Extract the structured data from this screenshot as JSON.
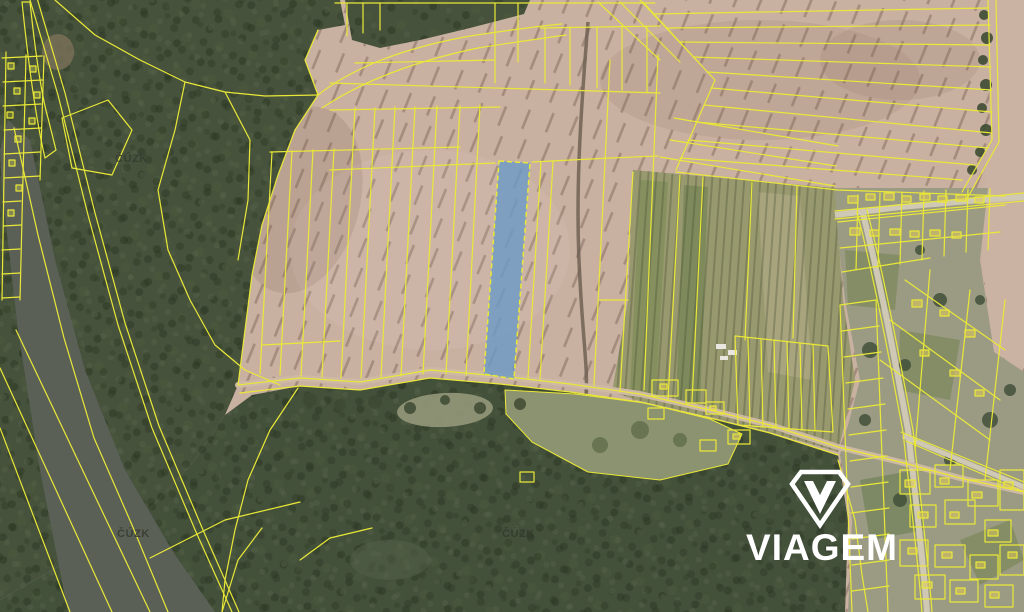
{
  "map": {
    "type": "cadastral-aerial-overlay",
    "watermarks": [
      {
        "label": "ČÚZK"
      },
      {
        "label": "ČÚZK"
      },
      {
        "label": "ČÚZK"
      }
    ],
    "branding": {
      "logo_text": "VIAGEM",
      "logo_color": "#ffffff"
    },
    "highlight": {
      "parcel_fill": "#6e9ac6",
      "parcel_fill_opacity": "0.82",
      "parcel_border": "#e9e838"
    },
    "colors": {
      "parcel_line": "#e9e838",
      "field": "#c9b1a1",
      "field_smooth": "#cbb3a3",
      "forest": "#46523b",
      "water": "#5b6057",
      "village": "#9b9b84",
      "meadow": "#8c9370",
      "road": "#cfc8b4"
    }
  }
}
